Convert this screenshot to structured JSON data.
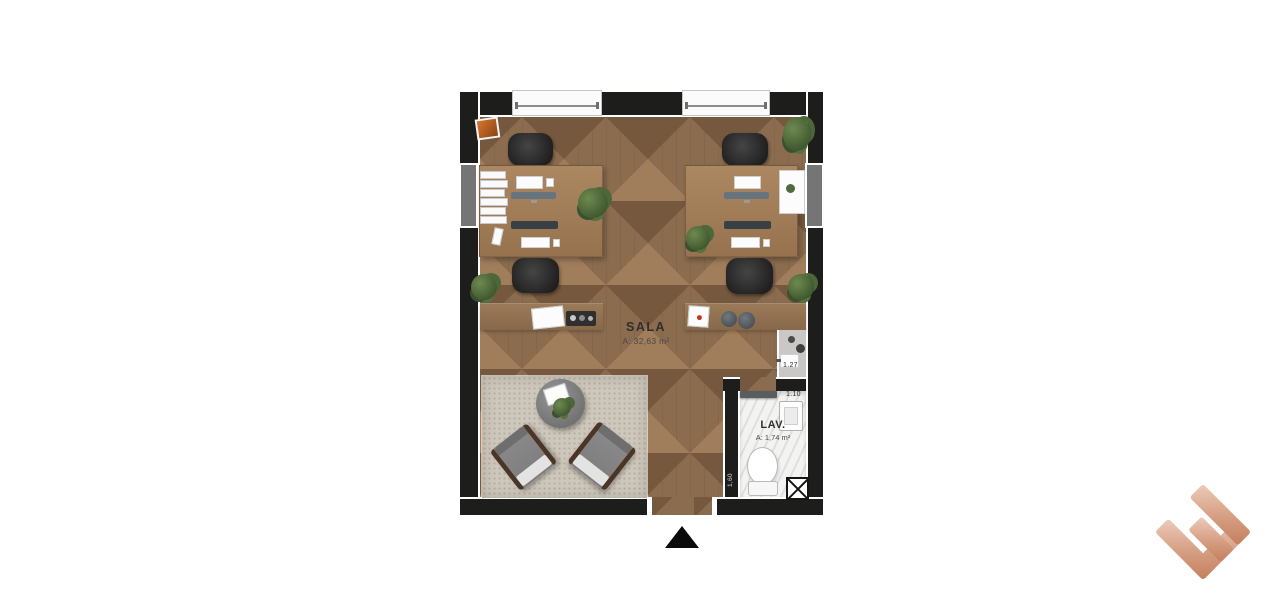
{
  "plan": {
    "room": {
      "label": "SALA",
      "area_label": "A: 32,63 m²"
    },
    "lav": {
      "label": "LAV.",
      "area_label": "A: 1,74 m²"
    },
    "dimensions": {
      "sink_run": "1.27",
      "lav_width": "1.10",
      "lav_depth": "1,60"
    },
    "markers": {
      "entrance_arrow_icon": "entrance-arrow"
    },
    "colors": {
      "wall": "#1d1d1b",
      "floor_base": "#8b6c4e",
      "floor_light": "#a07d5b",
      "floor_dark": "#75583d",
      "desk_wood": "#a6835e",
      "rug": "#cec7bb",
      "lav_floor": "#f3f3f1",
      "counter": "#c9c8c6",
      "chair_dark": "#2c2c2c",
      "logo_light": "#eccbb9",
      "logo_dark": "#c57e5e"
    }
  },
  "branding": {
    "logo_icon": "brand-e-monogram"
  }
}
